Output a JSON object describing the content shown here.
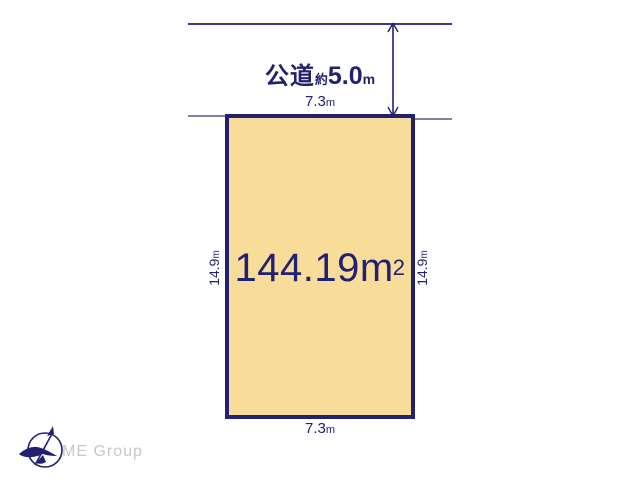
{
  "diagram": {
    "road": {
      "name": "公道",
      "approx": "約",
      "width_value": "5.0",
      "width_unit": "m"
    },
    "plot": {
      "area_value": "144.19",
      "area_unit": "m",
      "area_exponent": "2",
      "frontage_top": {
        "value": "7.3",
        "unit": "m"
      },
      "frontage_bottom": {
        "value": "7.3",
        "unit": "m"
      },
      "depth_left": {
        "value": "14.9",
        "unit": "m"
      },
      "depth_right": {
        "value": "14.9",
        "unit": "m"
      }
    },
    "logo": {
      "text": "ME Group"
    },
    "icons": {
      "compass": "north-compass-icon"
    },
    "colors": {
      "outline_navy": "#212170",
      "plot_fill": "#f8dc99",
      "road_line": "#3a3a85",
      "stub_line": "#8181a8",
      "logo_gray": "#c8c8c8",
      "background": "#ffffff"
    }
  }
}
